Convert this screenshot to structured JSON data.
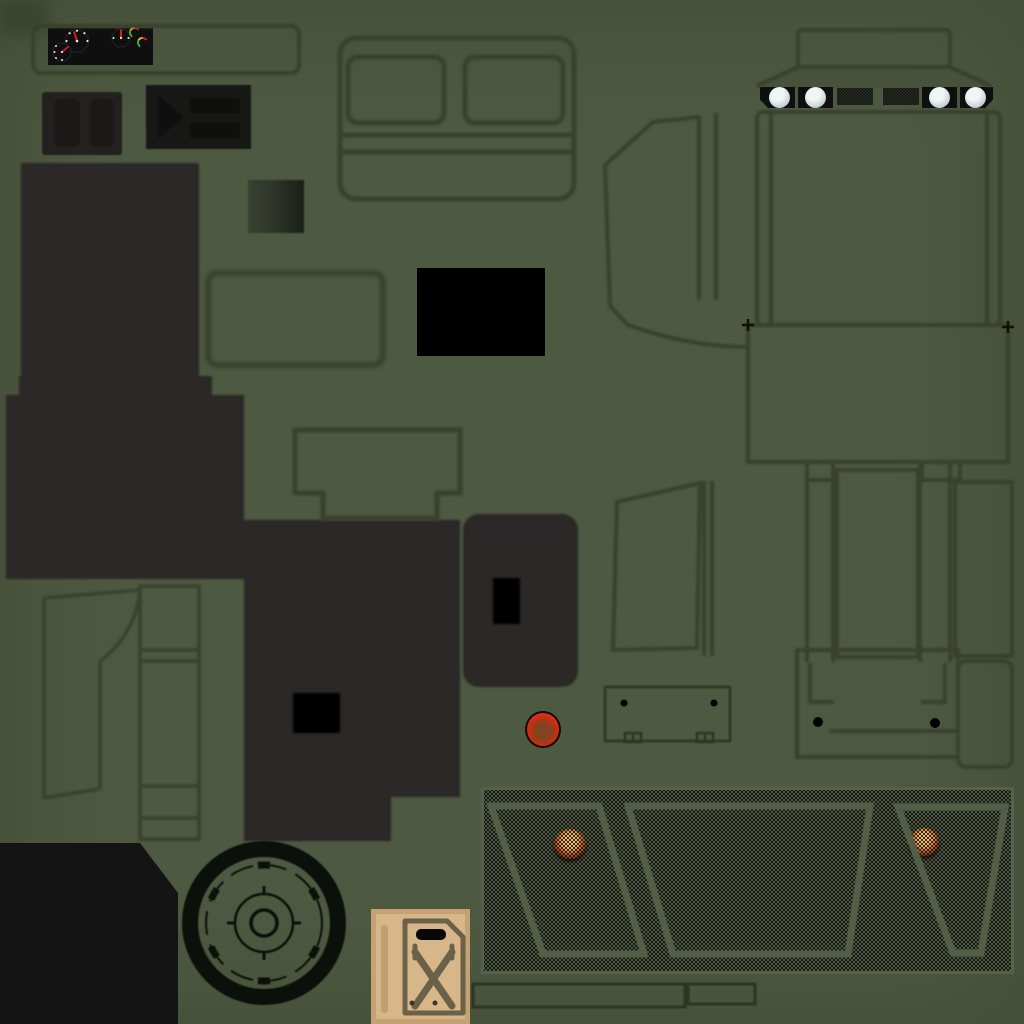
{
  "meta": {
    "asset_type": "game-texture-atlas",
    "subject": "military-vehicle-texture-sheet",
    "canvas": {
      "width": 1024,
      "height": 1024
    },
    "text_content": "none"
  },
  "palette": {
    "bg": "#4e5941",
    "bgCorner": "#353e29",
    "band": "#47523c",
    "outline": "#39412d",
    "outlineDark": "#2e3424",
    "lineBlack": "#101008",
    "charcoal": "#2b2827",
    "boxDark": "#232120",
    "boxDarker": "#1b1918",
    "boxDark2": "#171716",
    "boxDarker2": "#0f0f0e",
    "panelBlack": "#0f0f0f",
    "black": "#000000",
    "ink": "#141414",
    "tan": "#d7b68a",
    "tanBorder": "#c4a273",
    "tanDetail": "#6b6148",
    "tanBar": "#bfa06e",
    "tanDot": "#3c3526",
    "redBright": "#d32c15",
    "redCore": "#7e4520",
    "domeEdge": "#140a06",
    "orangeHi": "#f2bd72",
    "orangeLo": "#b04a1c",
    "lampWhite": "#f0f5f5",
    "lampMid": "#c7d1d3",
    "lampRim": "#8c9698",
    "meshBase": "#4c5640",
    "meshEdge": "#55614a",
    "meshLine": "#525e46",
    "meshDot": "#0d0d0d",
    "slotBase": "#3f4936",
    "needle": "#d42020",
    "gaugeTick": "#e8e8e8",
    "gaugeRim": "#262626",
    "arcGreen": "#3fae3f",
    "arcYellow": "#e0c020",
    "arcRed": "#cc2222",
    "gradA": "#3a4132",
    "gradB": "#2e352a",
    "gradC": "#1a1f17",
    "wheelInk": "#0c100a"
  },
  "inventory": {
    "headlights": 4,
    "grille_mesh_slots": 2,
    "round_gauges": 3,
    "mini_arc_gauges": 2,
    "mesh_window_cutouts": 3,
    "orange_dome_lights": 2,
    "red_dome_lights": 1,
    "jerry_cans": 1,
    "steering_wheels": 1
  },
  "regions": [
    "gauge-bezel-outline",
    "instrument-cluster",
    "speedometer-gauge",
    "fuel-gauge",
    "temp-gauge",
    "mini-arc-gauge-1",
    "mini-arc-gauge-2",
    "pedal-box",
    "switch-panel",
    "seat-back-panel",
    "hood-top-outline",
    "hood-flare-band",
    "headlight-housing",
    "headlight-lens",
    "grille-mesh-slot",
    "gradient-swatch",
    "window-frame-outline",
    "solid-black-patch",
    "console-notch-outline",
    "floor-tub-dark",
    "seat-cushion-dark",
    "seat-side-panel-dark",
    "vent-window-outline",
    "a-pillar-lines",
    "fender-curve",
    "door-panel-outline",
    "hood-top-panel",
    "registration-mark",
    "rear-door-window-outline",
    "cargo-bed-columns",
    "rear-panel",
    "tailgate-panel",
    "tailgate-latch",
    "dome-light-red",
    "door-outline",
    "b-pillar-strip",
    "steering-wheel",
    "floor-pan-black",
    "jerry-can",
    "mesh-canvas",
    "window-cutout-left",
    "window-cutout-center",
    "window-cutout-right",
    "dome-light-orange-left",
    "dome-light-orange-right",
    "sill-rect-long",
    "sill-rect-short"
  ]
}
